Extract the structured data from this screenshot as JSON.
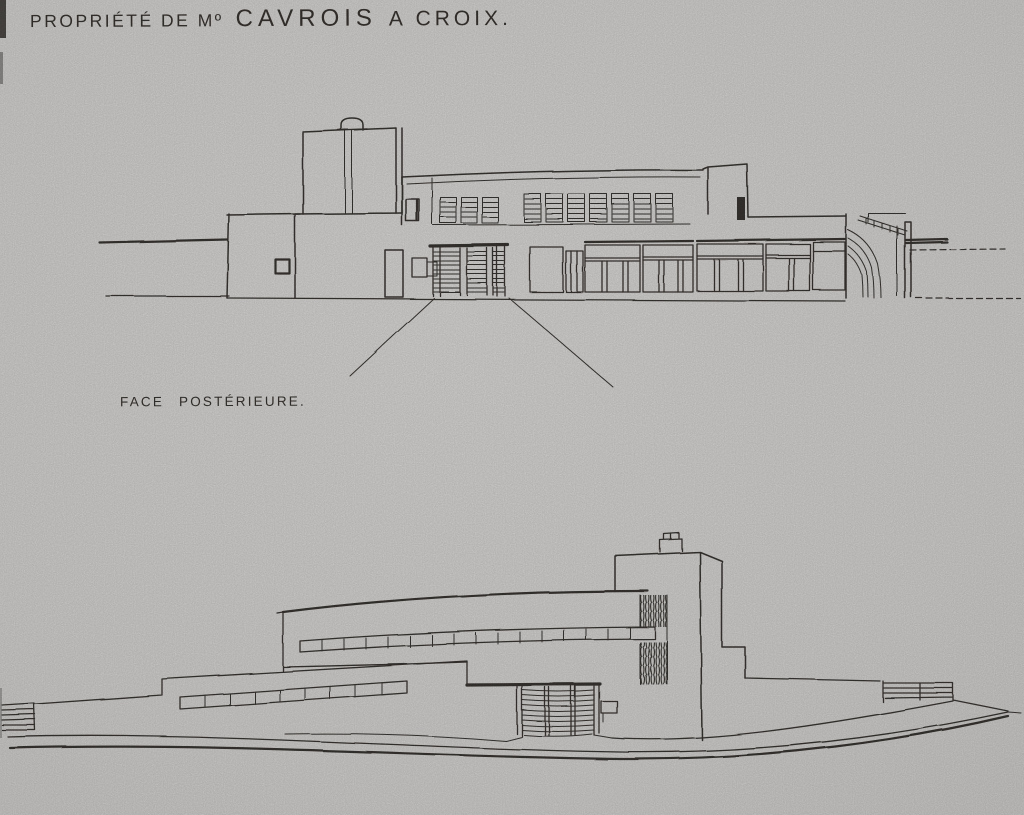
{
  "page": {
    "colors": {
      "paper": "#d3d1cf",
      "ink": "#383430",
      "edge": "#4b4845"
    },
    "header": {
      "title_lead": "PROPRIÉTÉ DE Mº",
      "title_name": "CAVROIS",
      "title_tail": "A CROIX."
    },
    "figures": {
      "rear_elevation": {
        "caption": "FACE POSTÉRIEURE."
      }
    }
  }
}
